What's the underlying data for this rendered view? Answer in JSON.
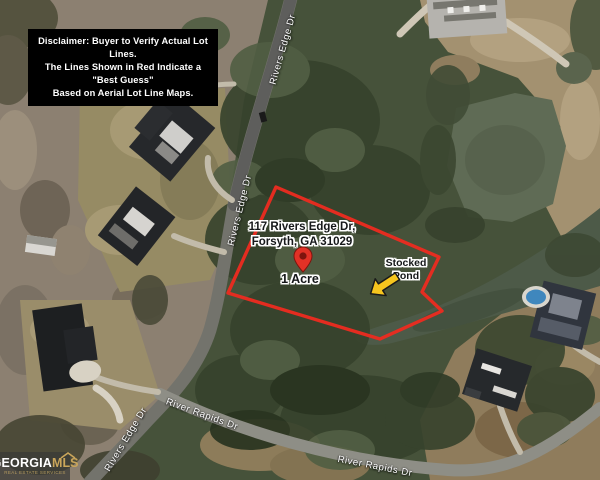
{
  "disclaimer": {
    "line1": "Disclaimer:  Buyer to Verify Actual Lot Lines.",
    "line2": "The Lines Shown in Red Indicate a \"Best Guess\"",
    "line3": "Based on Aerial Lot Line Maps."
  },
  "lot": {
    "address_line1": "117 Rivers Edge Dr,",
    "address_line2": "Forsyth, GA 31029",
    "size_label": "1 Acre",
    "pond_label": "Stocked\nPond",
    "polygon_points": "276,187 439,257 422,292 442,311 380,339 228,293",
    "line_color": "#ed2b20",
    "pin_color": "#e23126",
    "arrow_color": "#f6c51e"
  },
  "road_labels": [
    {
      "text": "Rivers Edge Dr"
    },
    {
      "text": "Rivers Edge Dr"
    },
    {
      "text": "Rivers Edge Dr"
    },
    {
      "text": "River Rapids Dr"
    },
    {
      "text": "River Rapids Dr"
    }
  ],
  "logo": {
    "brand_primary": "GEORGIA",
    "brand_secondary": "MLS",
    "tagline": "REAL ESTATE SERVICES"
  }
}
